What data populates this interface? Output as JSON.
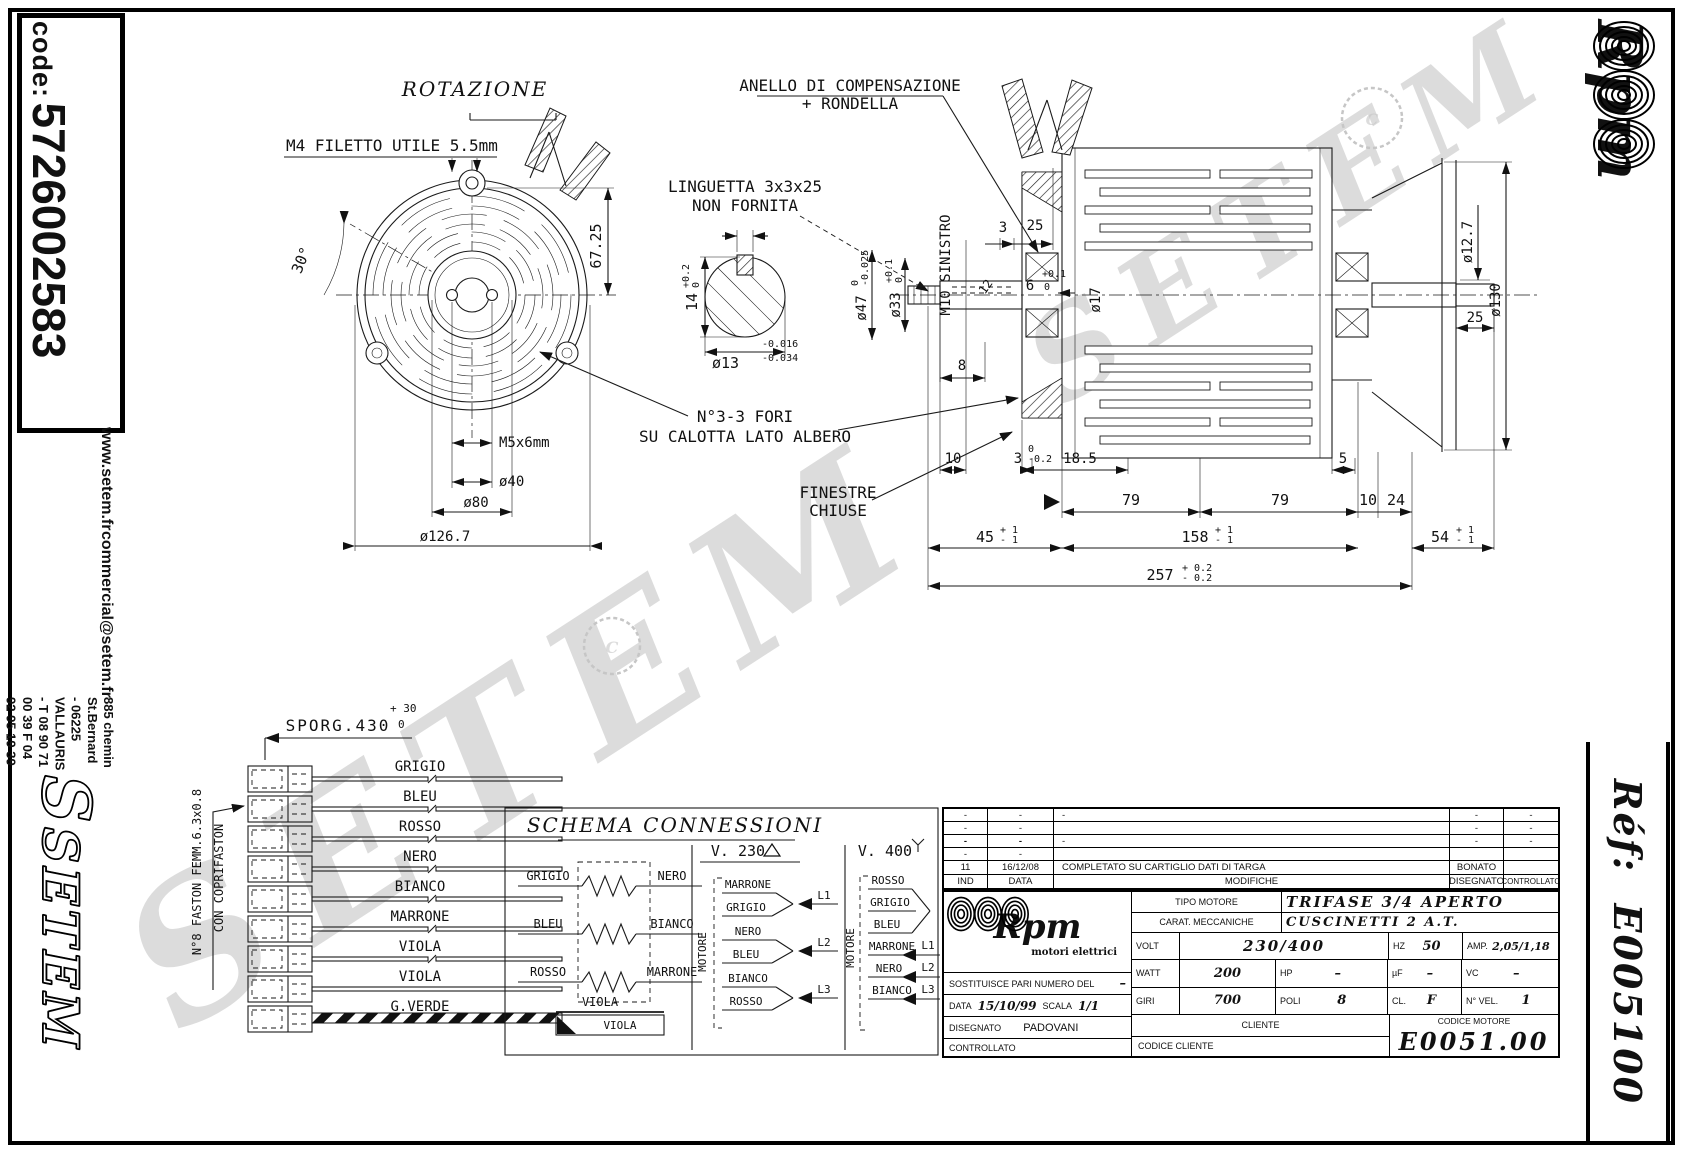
{
  "sheet": {
    "code_label": "code:",
    "code_value": "5726002583",
    "website": "www.setem.fr",
    "email": "commercial@setem.fr",
    "address": "885 chemin St.Bernard - 06225 VALLAURIS - T 08 90 71 00 39 F 04 92 95 19 39",
    "setem_logo": "SETEM",
    "setem_emblem": "S",
    "rpm_logo": "Rpm",
    "ref_label": "Réf:",
    "ref_value": "E005100",
    "watermark": "SETEM",
    "copyright": "C"
  },
  "front_view": {
    "rotation_label": "ROTAZIONE",
    "thread_note": "M4 FILETTO UTILE 5.5mm",
    "angle": "30°",
    "height_dim": "67.25",
    "hub_thread": "M5x6mm",
    "dia_40": "ø40",
    "dia_80": "ø80",
    "dia_flange": "ø126.7"
  },
  "key_detail": {
    "line1": "LINGUETTA 3x3x25",
    "line2": "NON FORNITA",
    "key_width": "3",
    "depth": "14",
    "depth_tol_hi": "+0.2",
    "depth_tol_lo": "0",
    "shaft_dia": "ø13",
    "shaft_tol_hi": "-0.016",
    "shaft_tol_lo": "-0.034"
  },
  "side_view": {
    "anello_line1": "ANELLO DI COMPENSAZIONE",
    "anello_line2": "+ RONDELLA",
    "dim_3_top": "3",
    "dim_25_top": "25",
    "dim_6": "6",
    "dim_6_tol_hi": "+0.1",
    "dim_6_tol_lo": "0",
    "left_thread": "M10 SINISTRO",
    "dim_12": "12",
    "dia_47": "ø47",
    "dia_47_tol_hi": "0",
    "dia_47_tol_lo": "-0.025",
    "dia_33": "ø33",
    "dia_33_tol_hi": "+0.1",
    "dia_33_tol_lo": "0",
    "dia_17": "ø17",
    "dim_8": "8",
    "dia_127": "ø12.7",
    "dia_130": "ø130",
    "dim_25_right": "25",
    "fori_line1": "N°3-3 FORI",
    "fori_line2": "SU CALOTTA LATO ALBERO",
    "finestre_line1": "FINESTRE",
    "finestre_line2": "CHIUSE",
    "dim_10_left": "10",
    "dim_3b": "3",
    "dim_3b_tol_hi": "0",
    "dim_3b_tol_lo": "-0.2",
    "dim_185": "18.5",
    "dim_5": "5",
    "dim_79a": "79",
    "dim_79b": "79",
    "dim_10_right": "10",
    "dim_24": "24",
    "dim_45": "45",
    "dim_158": "158",
    "dim_54": "54",
    "tol_p1": "+ 1",
    "tol_m1": "- 1",
    "dim_257": "257",
    "dim_257_tol_hi": "+ 0.2",
    "dim_257_tol_lo": "- 0.2"
  },
  "harness": {
    "sporg": "SPORG.430",
    "sporg_tol_hi": "+ 30",
    "sporg_tol_lo": "0",
    "note_line1": "N°8 FASTON FEMM.6.3x0.8",
    "note_line2": "CON COPRIFASTON",
    "wires": [
      "GRIGIO",
      "BLEU",
      "ROSSO",
      "NERO",
      "BIANCO",
      "MARRONE",
      "VIOLA",
      "VIOLA",
      "G.VERDE"
    ]
  },
  "schema": {
    "title": "SCHEMA CONNESSIONI",
    "windings": [
      {
        "left": "GRIGIO",
        "right": "NERO"
      },
      {
        "left": "BLEU",
        "right": "BIANCO"
      },
      {
        "left": "ROSSO",
        "right": "MARRONE"
      }
    ],
    "viola_top": "VIOLA",
    "viola_box": "VIOLA",
    "motor_label": "MOTORE",
    "v230": {
      "title": "V. 230",
      "groups": [
        {
          "top": "MARRONE",
          "bottom": "GRIGIO",
          "term": "L1"
        },
        {
          "top": "NERO",
          "bottom": "BLEU",
          "term": "L2"
        },
        {
          "top": "BIANCO",
          "bottom": "ROSSO",
          "term": "L3"
        }
      ]
    },
    "v400": {
      "title": "V. 400",
      "star": [
        "ROSSO",
        "GRIGIO",
        "BLEU"
      ],
      "lines": [
        {
          "wire": "MARRONE",
          "term": "L1"
        },
        {
          "wire": "NERO",
          "term": "L2"
        },
        {
          "wire": "BIANCO",
          "term": "L3"
        }
      ]
    }
  },
  "revisions": {
    "dash": "-",
    "rev_ind": "11",
    "rev_date": "16/12/08",
    "rev_desc": "COMPLETATO SU CARTIGLIO DATI DI TARGA",
    "rev_by": "BONATO",
    "h_ind": "IND",
    "h_data": "DATA",
    "h_modifiche": "MODIFICHE",
    "h_disegnato": "DISEGNATO",
    "h_controllato": "CONTROLLATO"
  },
  "titleblock": {
    "brand": "Rpm",
    "brand_sub": "motori elettrici",
    "tipo_label": "TIPO MOTORE",
    "tipo_value": "TRIFASE 3/4 APERTO",
    "carat_label": "CARAT. MECCANICHE",
    "carat_value": "CUSCINETTI 2 A.T.",
    "volt_label": "VOLT",
    "volt_value": "230/400",
    "hz_label": "HZ",
    "hz_value": "50",
    "amp_label": "AMP.",
    "amp_value": "2,05/1,18",
    "watt_label": "WATT",
    "watt_value": "200",
    "hp_label": "HP",
    "hp_value": "–",
    "uf_label": "µF",
    "uf_value": "–",
    "vc_label": "VC",
    "vc_value": "–",
    "giri_label": "GIRI",
    "giri_value": "700",
    "poli_label": "POLI",
    "poli_value": "8",
    "cl_label": "CL.",
    "cl_value": "F",
    "nvel_label": "N° VEL.",
    "nvel_value": "1",
    "sost_label": "SOSTITUISCE PARI NUMERO DEL",
    "sost_value": "–",
    "data_label": "DATA",
    "data_value": "15/10/99",
    "scala_label": "SCALA",
    "scala_value": "1/1",
    "disegnato_label": "DISEGNATO",
    "disegnato_value": "PADOVANI",
    "controllato_label": "CONTROLLATO",
    "cliente_label": "CLIENTE",
    "codice_cliente_label": "CODICE CLIENTE",
    "codice_motore_label": "CODICE MOTORE",
    "codice_motore_value": "E0051.00"
  }
}
